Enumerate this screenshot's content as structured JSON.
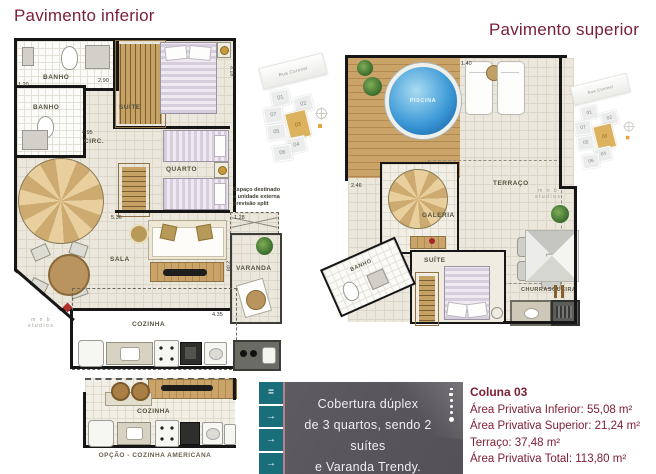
{
  "titles": {
    "lower": "Pavimento inferior",
    "upper": "Pavimento superior"
  },
  "lower_plan": {
    "rooms": {
      "banho1": "BANHO",
      "banho2": "BANHO",
      "suite": "SUÍTE",
      "circ": "CIRC.",
      "quarto": "QUARTO",
      "sala": "SALA",
      "varanda": "VARANDA",
      "cozinha": "COZINHA"
    },
    "split_note": [
      "Espaço destinado",
      "a unidade externa",
      "previsão split"
    ],
    "dims": [
      "2.90",
      "1.20",
      "4.95",
      "5.36",
      "4.35",
      "1.28",
      "3.18",
      "2.08"
    ]
  },
  "kitchen_option": {
    "room": "COZINHA",
    "caption": "OPÇÃO - COZINHA AMERICANA"
  },
  "upper_plan": {
    "rooms": {
      "piscina": "PISCINA",
      "terraco": "TERRAÇO",
      "galeria": "GALERIA",
      "banho": "BANHO",
      "suite": "SUÍTE",
      "churrasqueira": "CHURRASQUEIRA"
    },
    "dims": [
      "1.40",
      "2.46"
    ]
  },
  "key_plan": {
    "street": "Rua Coronel",
    "units": [
      "01",
      "02",
      "07",
      "03",
      "05",
      "04",
      "06"
    ],
    "highlighted_unit": "03"
  },
  "banner": {
    "nav_icons": [
      "=",
      "→",
      "→",
      "→"
    ],
    "lines": [
      "Cobertura dúplex",
      "de 3 quartos, sendo 2 suítes",
      "e Varanda Trendy."
    ]
  },
  "info_panel": {
    "title": "Coluna 03",
    "lines": [
      "Área Privativa Inferior: 55,08 m²",
      "Área Privativa Superior: 21,24 m²",
      "Terraço: 37,48 m²",
      "Área Privativa Total: 113,80 m²"
    ]
  },
  "watermark": {
    "line1": "m n b",
    "line2": "studios"
  },
  "colors": {
    "accent_maroon": "#7b2038",
    "teal": "#1a6e79",
    "banner_gray": "#59565c",
    "highlight_tan": "#dcb25e"
  }
}
